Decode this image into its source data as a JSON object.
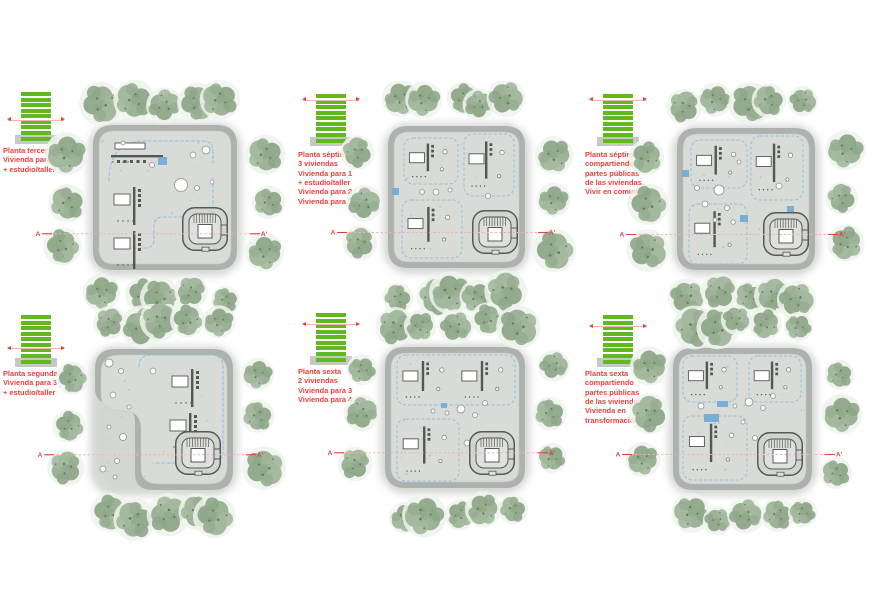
{
  "page": {
    "width": 876,
    "height": 615,
    "background": "#ffffff"
  },
  "colors": {
    "accent_red": "#e6413b",
    "section_line_pink": "#f0b3ad",
    "floor_green": "#62b81f",
    "base_gray": "#c7c7c5",
    "slab_ring": "#aeb2ae",
    "slab_deck": "#d9dbd7",
    "unit_blue": "#8fc0e3",
    "blue_solid": "#74add6",
    "wall_dark": "#545854",
    "tree_halo": "#eef3ec",
    "tree_speckle": "#5f7a5c",
    "circle_stroke": "#8d918d"
  },
  "tiles": [
    {
      "id": "planta-tercera",
      "title": "Planta tercera",
      "desc": "Vivienda para 5\n+ estudio/taller",
      "floor_level": 3,
      "total_floors": 8,
      "section_left": "A",
      "section_right": "A'",
      "icon": {
        "x": 8,
        "y": 90
      },
      "label": {
        "x": 3,
        "y": 146
      },
      "plan": {
        "slab": {
          "x": 93,
          "y": 125,
          "w": 144,
          "h": 145
        },
        "notch": false,
        "seed": 7,
        "stair": {
          "x": 89,
          "y": 82
        },
        "units": [],
        "clusters": [
          [
            44,
            24,
            "h"
          ],
          [
            40,
            62,
            "v"
          ],
          [
            40,
            106,
            "v"
          ]
        ],
        "blue_rects": [
          [
            65,
            32,
            9,
            8
          ]
        ],
        "circles": [
          [
            100,
            30,
            3
          ],
          [
            113,
            25,
            4
          ],
          [
            88,
            60,
            6.5
          ],
          [
            104,
            63,
            2.5
          ],
          [
            119,
            57,
            2
          ],
          [
            59,
            40,
            2.5
          ],
          [
            98,
            94,
            3
          ],
          [
            30,
            18,
            2
          ]
        ],
        "route": "M 16 56 Q 16 16 52 16 L 110 16 Q 120 16 120 26 L 120 38 M 120 54 L 120 82 Q 120 92 110 92 L 70 92 Q 61 92 61 101 L 61 114 Q 61 123 52 123 L 22 123"
      }
    },
    {
      "id": "planta-septima-viviendas",
      "title": "Planta séptima",
      "desc": "3 viviendas\nVivienda para 1\n+ estudio/taller\nVivienda para 2\nVivienda para 3",
      "floor_level": 7,
      "total_floors": 8,
      "section_left": "A",
      "section_right": "A'",
      "icon": {
        "x": 303,
        "y": 92
      },
      "label": {
        "x": 298,
        "y": 150
      },
      "plan": {
        "slab": {
          "x": 388,
          "y": 126,
          "w": 137,
          "h": 142
        },
        "notch": false,
        "seed": 13,
        "stair": {
          "x": 84,
          "y": 84
        },
        "units": [
          [
            16,
            12,
            54,
            46
          ],
          [
            76,
            8,
            50,
            62
          ],
          [
            14,
            74,
            60,
            58
          ]
        ],
        "clusters": [],
        "blue_rects": [
          [
            4,
            62,
            7,
            7
          ]
        ],
        "circles": [
          [
            48,
            66,
            3
          ],
          [
            62,
            64,
            2
          ],
          [
            34,
            66,
            2.5
          ],
          [
            100,
            70,
            2.5
          ]
        ],
        "route": null
      }
    },
    {
      "id": "planta-septima-comunidad",
      "title": "Planta séptima",
      "desc": "compartiendo\npartes públicas\nde las viviendas.\nVivir en comunidad",
      "floor_level": 7,
      "total_floors": 8,
      "section_left": "A",
      "section_right": "A'",
      "icon": {
        "x": 590,
        "y": 92
      },
      "label": {
        "x": 585,
        "y": 150
      },
      "plan": {
        "slab": {
          "x": 677,
          "y": 128,
          "w": 138,
          "h": 142
        },
        "notch": false,
        "seed": 29,
        "stair": {
          "x": 86,
          "y": 84
        },
        "units": [
          [
            14,
            12,
            56,
            48
          ],
          [
            74,
            8,
            52,
            64
          ],
          [
            12,
            76,
            58,
            60
          ]
        ],
        "clusters": [],
        "blue_rects": [
          [
            5,
            42,
            7,
            7
          ],
          [
            63,
            87,
            8,
            7
          ],
          [
            110,
            78,
            7,
            6
          ]
        ],
        "circles": [
          [
            42,
            62,
            5
          ],
          [
            28,
            76,
            3
          ],
          [
            50,
            80,
            2.5
          ],
          [
            38,
            92,
            2
          ],
          [
            102,
            58,
            3
          ],
          [
            62,
            34,
            2
          ],
          [
            20,
            60,
            2.5
          ]
        ],
        "route": null
      }
    },
    {
      "id": "planta-segunda",
      "title": "Planta segunda",
      "desc": "Vivienda para 3\n+ estudio/taller",
      "floor_level": 2,
      "total_floors": 8,
      "section_left": "A",
      "section_right": "A'",
      "icon": {
        "x": 8,
        "y": 313
      },
      "label": {
        "x": 3,
        "y": 369
      },
      "plan": {
        "slab": {
          "x": 95,
          "y": 349,
          "w": 138,
          "h": 141
        },
        "notch": true,
        "seed": 41,
        "stair": {
          "x": 80,
          "y": 82
        },
        "units": [],
        "clusters": [
          [
            96,
            20,
            "v"
          ],
          [
            94,
            64,
            "v"
          ]
        ],
        "blue_rects": [],
        "circles": [
          [
            14,
            14,
            4
          ],
          [
            26,
            22,
            2.5
          ],
          [
            18,
            46,
            3
          ],
          [
            28,
            88,
            3.5
          ],
          [
            14,
            78,
            2
          ],
          [
            22,
            112,
            2.5
          ],
          [
            58,
            22,
            3
          ],
          [
            34,
            58,
            2
          ],
          [
            8,
            120,
            3
          ],
          [
            20,
            128,
            2
          ]
        ],
        "route": "M 44 18 Q 44 6 56 6 L 116 6 Q 128 6 128 18 L 128 102 Q 128 114 116 114 L 58 114"
      }
    },
    {
      "id": "planta-sexta-viviendas",
      "title": "Planta sexta",
      "desc": "2 viviendas\nVivienda para 3\nVivienda para 4",
      "floor_level": 6,
      "total_floors": 8,
      "section_left": "A",
      "section_right": "A'",
      "icon": {
        "x": 303,
        "y": 311
      },
      "label": {
        "x": 298,
        "y": 367
      },
      "plan": {
        "slab": {
          "x": 385,
          "y": 347,
          "w": 140,
          "h": 141
        },
        "notch": false,
        "seed": 53,
        "stair": {
          "x": 84,
          "y": 84
        },
        "units": [
          [
            12,
            8,
            118,
            50
          ],
          [
            12,
            72,
            62,
            62
          ]
        ],
        "clusters": [],
        "blue_rects": [
          [
            56,
            56,
            6,
            5
          ]
        ],
        "circles": [
          [
            76,
            62,
            4
          ],
          [
            90,
            68,
            2.5
          ],
          [
            62,
            66,
            2
          ],
          [
            100,
            56,
            2.5
          ],
          [
            82,
            96,
            3
          ],
          [
            48,
            64,
            2
          ]
        ],
        "route": null
      }
    },
    {
      "id": "planta-sexta-transformacion",
      "title": "Planta sexta",
      "desc": "compartiendo\npartes públicas\nde las viviendas\nVivienda en\ntransformación",
      "floor_level": 6,
      "total_floors": 8,
      "section_left": "A",
      "section_right": "A'",
      "icon": {
        "x": 590,
        "y": 313
      },
      "label": {
        "x": 585,
        "y": 369
      },
      "plan": {
        "slab": {
          "x": 673,
          "y": 348,
          "w": 139,
          "h": 142
        },
        "notch": false,
        "seed": 67,
        "stair": {
          "x": 84,
          "y": 84
        },
        "units": [
          [
            10,
            8,
            54,
            46
          ],
          [
            76,
            8,
            52,
            46
          ],
          [
            10,
            68,
            64,
            64
          ]
        ],
        "clusters": [],
        "blue_rects": [
          [
            44,
            53,
            11,
            6
          ],
          [
            31,
            66,
            15,
            8
          ]
        ],
        "circles": [
          [
            76,
            54,
            4
          ],
          [
            90,
            60,
            2.5
          ],
          [
            62,
            58,
            2
          ],
          [
            100,
            48,
            2.5
          ],
          [
            28,
            58,
            3
          ],
          [
            82,
            90,
            2.5
          ],
          [
            70,
            74,
            2
          ]
        ],
        "route": null
      }
    }
  ]
}
